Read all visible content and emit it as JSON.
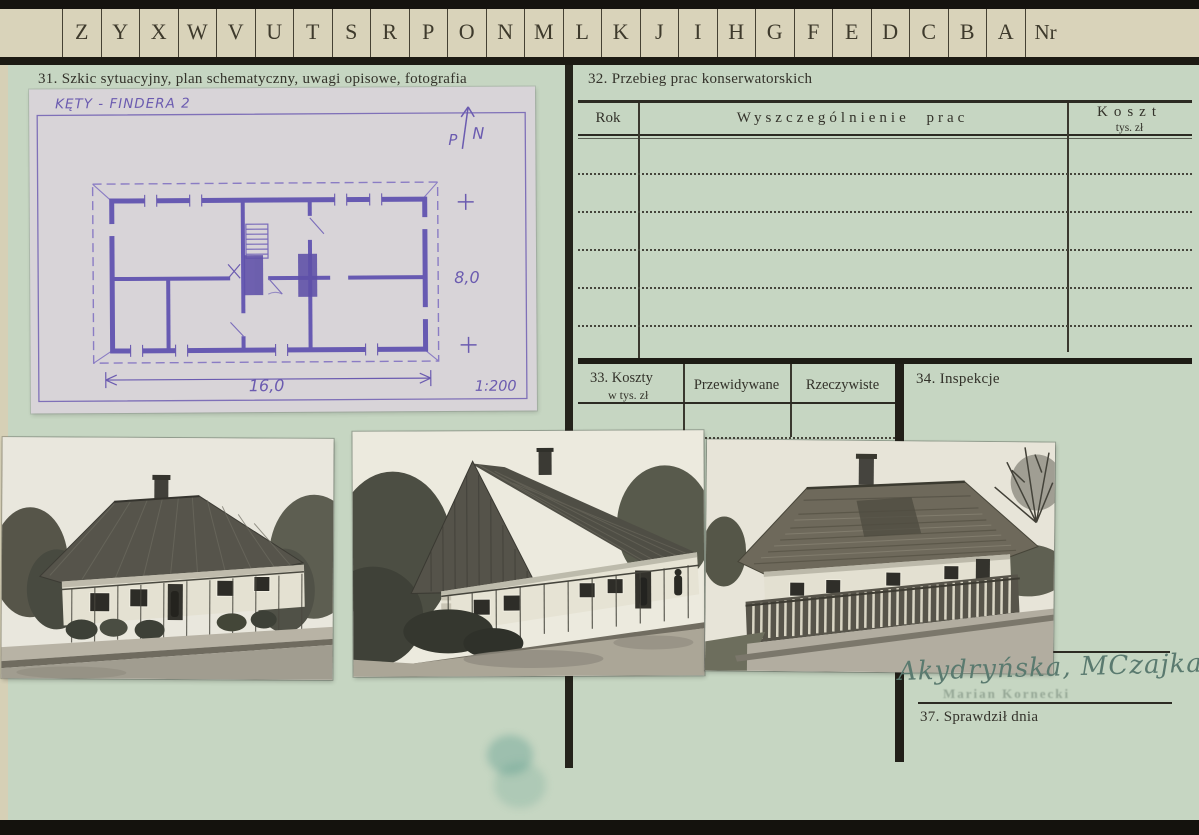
{
  "tab_row": {
    "letters": [
      "Z",
      "Y",
      "X",
      "W",
      "V",
      "U",
      "T",
      "S",
      "R",
      "P",
      "O",
      "N",
      "M",
      "L",
      "K",
      "J",
      "I",
      "H",
      "G",
      "F",
      "E",
      "D",
      "C",
      "B",
      "A"
    ],
    "nr_label": "Nr"
  },
  "sections": {
    "s31": {
      "title": "31. Szkic sytuacyjny, plan schematyczny, uwagi opisowe, fotografia"
    },
    "sketch": {
      "caption": "KĘTY - FINDERA 2",
      "north_p": "P",
      "north_n": "N",
      "dim_right": "8,0",
      "dim_bottom": "16,0",
      "scale": "1:200"
    },
    "s32": {
      "title": "32. Przebieg prac konserwatorskich",
      "col_rok": "Rok",
      "col_prace": "Wyszczególnienie prac",
      "col_koszt": "Koszt",
      "col_koszt_unit": "tys. zł",
      "empty_row_lines": 5
    },
    "s33": {
      "title": "33. Koszty",
      "unit": "w tys. zł",
      "col_expected": "Przewidywane",
      "col_actual": "Rzeczywiste"
    },
    "s34": {
      "title": "34. Inspekcje"
    },
    "s37": {
      "title": "37. Sprawdził dnia",
      "signature": "Akydryńska, MCzajka",
      "stamp": "Marian Kornecki"
    }
  },
  "photographs": [
    {
      "id": "photo-1",
      "description": "B&W photograph: cottage with tall sheet-metal hip roof, corner view, chain-link fence, street in front"
    },
    {
      "id": "photo-2",
      "description": "B&W photograph: same cottage, steep gable end with metal roof, figure by the door, chain-link fence"
    },
    {
      "id": "photo-3",
      "description": "B&W photograph: cottage with wood-shingled roof behind wooden picket fence, bare trees"
    }
  ],
  "colors": {
    "card_green": "#c6d6c2",
    "paper_beige": "#d9d3ba",
    "sketch_ink_purple": "#6b5bb0",
    "line_dark": "#24231b",
    "signature_ink": "#5a7a6f"
  }
}
